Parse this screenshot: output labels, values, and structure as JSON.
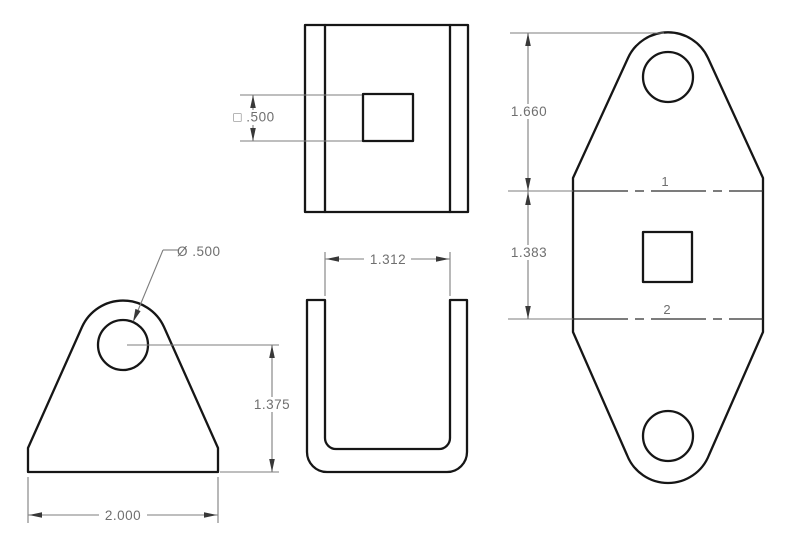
{
  "drawing": {
    "description": "multi-view sheet metal bracket drawing",
    "dimensions": {
      "square_hole": "□ .500",
      "hole_diameter": "Ø .500",
      "hole_center_height": "1.375",
      "base_width": "2.000",
      "channel_inner_width": "1.312",
      "flat_top_to_bend1": "1.660",
      "flat_bend1_to_bend2": "1.383"
    },
    "bend_lines": {
      "bend1": "1",
      "bend2": "2"
    },
    "colors": {
      "background": "#ffffff",
      "outline": "#161616",
      "dimension_lines": "#7d7d7d",
      "dimension_text": "#6f6f6f"
    }
  }
}
